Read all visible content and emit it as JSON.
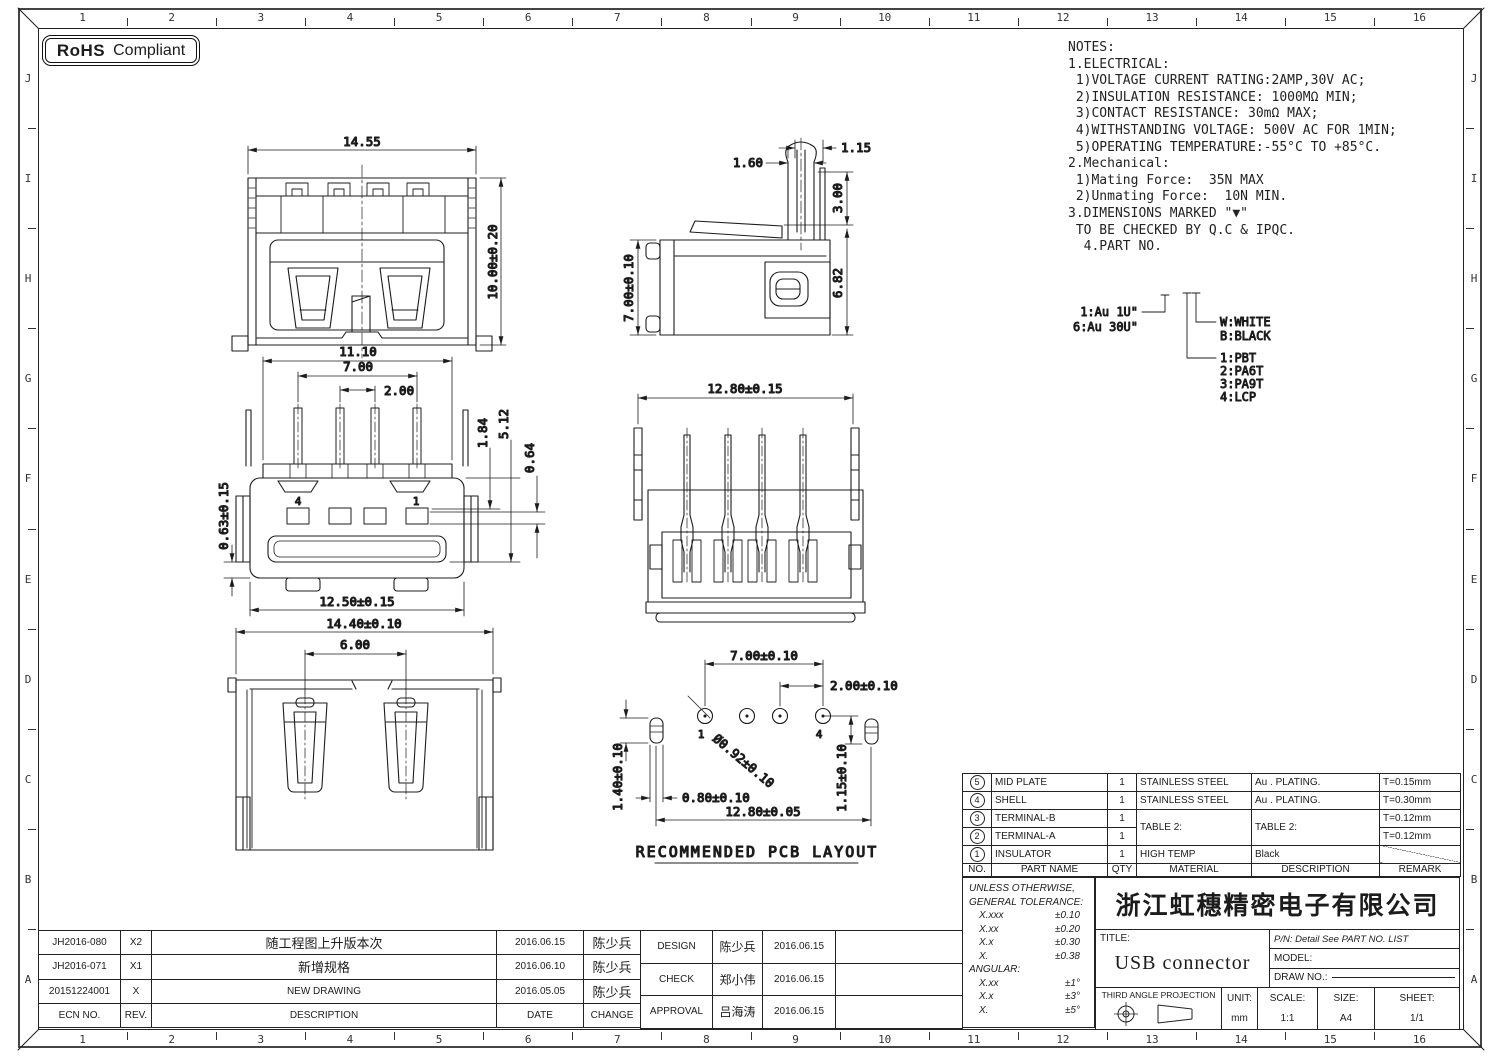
{
  "frame": {
    "cols": [
      "1",
      "2",
      "3",
      "4",
      "5",
      "6",
      "7",
      "8",
      "9",
      "10",
      "11",
      "12",
      "13",
      "14",
      "15",
      "16"
    ],
    "rows": [
      "J",
      "I",
      "H",
      "G",
      "F",
      "E",
      "D",
      "C",
      "B",
      "A"
    ]
  },
  "badge": {
    "bold": "RoHS",
    "text": "Compliant"
  },
  "notes": {
    "lines": [
      "NOTES:",
      "1.ELECTRICAL:",
      " 1)VOLTAGE CURRENT RATING:2AMP,30V AC;",
      " 2)INSULATION RESISTANCE: 1000MΩ MIN;",
      " 3)CONTACT RESISTANCE: 30mΩ MAX;",
      " 4)WITHSTANDING VOLTAGE: 500V AC FOR 1MIN;",
      " 5)OPERATING TEMPERATURE:-55°C TO +85°C.",
      "2.Mechanical:",
      " 1)Mating Force:  35N MAX",
      " 2)Unmating Force:  10N MIN.",
      "3.DIMENSIONS MARKED \"▼\"",
      " TO BE CHECKED BY Q.C & IPQC.",
      "",
      "  4.PART NO."
    ]
  },
  "legend": {
    "au1": "1:Au 1U\"",
    "au6": "6:Au 30U\"",
    "w": "W:WHITE",
    "b": "B:BLACK",
    "m1": "1:PBT",
    "m2": "2:PA6T",
    "m3": "3:PA9T",
    "m4": "4:LCP"
  },
  "views": {
    "front": {
      "w": "14.55",
      "h": "10.00±0.20"
    },
    "side": {
      "d115": "1.15",
      "d160": "1.60",
      "d300": "3.00",
      "d682": "6.82",
      "h": "7.00±0.10"
    },
    "top": {
      "w": "11.10",
      "p7": "7.00",
      "p2": "2.00",
      "d184": "1.84",
      "d512": "5.12",
      "d064": "0.64",
      "left": "0.63±0.15",
      "bottom": "12.50±0.15",
      "pin4": "4",
      "pin1": "1"
    },
    "rear": {
      "w": "12.80±0.15"
    },
    "bottom": {
      "w": "14.40±0.10",
      "inner": "6.00"
    },
    "pcb": {
      "p7": "7.00±0.10",
      "p2": "2.00±0.10",
      "dia": "Ø0.92±0.10",
      "slot_h": "1.40±0.10",
      "slot_w": "0.80±0.10",
      "offset": "1.15±0.10",
      "w": "12.80±0.05",
      "pin1": "1",
      "pin4": "4",
      "caption": "RECOMMENDED PCB LAYOUT"
    }
  },
  "bom": {
    "headers": [
      "NO.",
      "PART NAME",
      "QTY",
      "MATERIAL",
      "DESCRIPTION",
      "REMARK"
    ],
    "rows": [
      {
        "no": "5",
        "name": "MID PLATE",
        "qty": "1",
        "mat": "STAINLESS STEEL",
        "desc": "Au . PLATING.",
        "rem": "T=0.15mm"
      },
      {
        "no": "4",
        "name": "SHELL",
        "qty": "1",
        "mat": "STAINLESS STEEL",
        "desc": "Au . PLATING.",
        "rem": "T=0.30mm"
      },
      {
        "no": "3",
        "name": "TERMINAL-B",
        "qty": "1",
        "mat": "TABLE 2:",
        "desc": "TABLE 2:",
        "rem": "T=0.12mm"
      },
      {
        "no": "2",
        "name": "TERMINAL-A",
        "qty": "1",
        "mat": "",
        "desc": "",
        "rem": "T=0.12mm"
      },
      {
        "no": "1",
        "name": "INSULATOR",
        "qty": "1",
        "mat": "HIGH TEMP",
        "desc": "Black",
        "rem": ""
      }
    ]
  },
  "tolerance": {
    "line1": "UNLESS OTHERWISE,",
    "line2": "GENERAL TOLERANCE:",
    "rows": [
      [
        "X.xxx",
        "±0.10"
      ],
      [
        "X.xx",
        "±0.20"
      ],
      [
        "X.x",
        "±0.30"
      ],
      [
        "X.",
        "±0.38"
      ]
    ],
    "angular": "ANGULAR:",
    "ang_rows": [
      [
        "X.xx",
        "±1°"
      ],
      [
        "X.x",
        "±3°"
      ],
      [
        "X.",
        "±5°"
      ]
    ]
  },
  "titleblock": {
    "company": "浙江虹穗精密电子有限公司",
    "title_label": "TITLE:",
    "title": "USB connector",
    "pn": "P/N: Detail See PART NO. LIST",
    "model_label": "MODEL:",
    "drawno_label": "DRAW NO.:",
    "projection": "THIRD ANGLE PROJECTION",
    "unit_label": "UNIT:",
    "unit": "mm",
    "scale_label": "SCALE:",
    "scale": "1:1",
    "size_label": "SIZE:",
    "size": "A4",
    "sheet_label": "SHEET:",
    "sheet": "1/1"
  },
  "revisions": {
    "headers": [
      "ECN NO.",
      "REV.",
      "DESCRIPTION",
      "DATE",
      "CHANGE"
    ],
    "rows": [
      {
        "ecn": "JH2016-080",
        "rev": "X2",
        "desc": "随工程图上升版本次",
        "date": "2016.06.15",
        "chg": "陈少兵"
      },
      {
        "ecn": "JH2016-071",
        "rev": "X1",
        "desc": "新增规格",
        "date": "2016.06.10",
        "chg": "陈少兵"
      },
      {
        "ecn": "20151224001",
        "rev": "X",
        "desc": "NEW DRAWING",
        "date": "2016.05.05",
        "chg": "陈少兵"
      }
    ]
  },
  "approvals": {
    "rows": [
      {
        "role": "DESIGN",
        "name": "陈少兵",
        "date": "2016.06.15"
      },
      {
        "role": "CHECK",
        "name": "郑小伟",
        "date": "2016.06.15"
      },
      {
        "role": "APPROVAL",
        "name": "吕海涛",
        "date": "2016.06.15"
      }
    ]
  }
}
